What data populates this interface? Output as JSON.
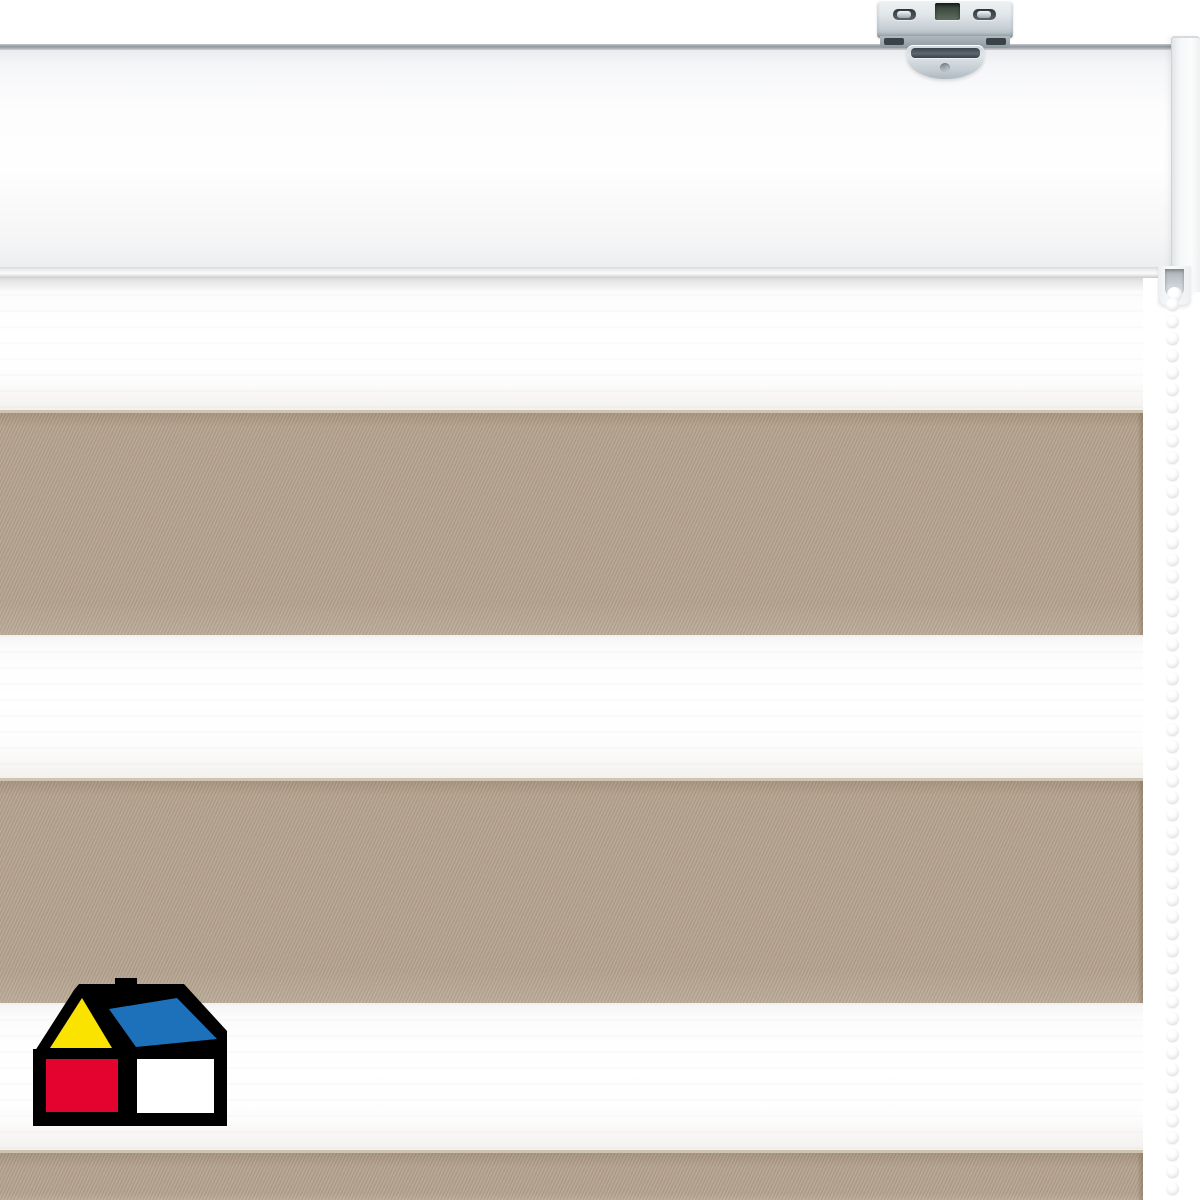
{
  "scene": {
    "description": "Product photo of a day-night zebra roller blind: white cassette head rail with metal ceiling bracket, fabric with alternating white sheer and beige solid stripes, white bead chain on the right, brand house logo at bottom left",
    "background_color": "#ffffff"
  },
  "headrail": {
    "color": "#fafbfc",
    "top_edge_color": "#8f969c",
    "endcap_color": "#f6f7f8"
  },
  "bracket": {
    "metal_color": "#d5dce1",
    "slot_color": "#3b4248",
    "center_hole_color": "#48564a"
  },
  "blind": {
    "fabric_colors": {
      "sheer": "#fdfdfd",
      "solid": "#b2a08b"
    },
    "stripes": [
      {
        "type": "sheer",
        "top": 278,
        "height": 132
      },
      {
        "type": "solid",
        "top": 410,
        "height": 225
      },
      {
        "type": "sheer",
        "top": 635,
        "height": 143
      },
      {
        "type": "solid",
        "top": 778,
        "height": 225
      },
      {
        "type": "sheer",
        "top": 1003,
        "height": 147
      },
      {
        "type": "solid",
        "top": 1150,
        "height": 50
      }
    ]
  },
  "chain": {
    "bead_color": "#f3f4f5",
    "bead_count": 53
  },
  "logo": {
    "name": "sodimac-homecenter-house",
    "colors": {
      "outline": "#000000",
      "gable": "#fbe300",
      "roof": "#1d71ba",
      "wall_left": "#e4032e",
      "wall_right": "#ffffff"
    }
  }
}
